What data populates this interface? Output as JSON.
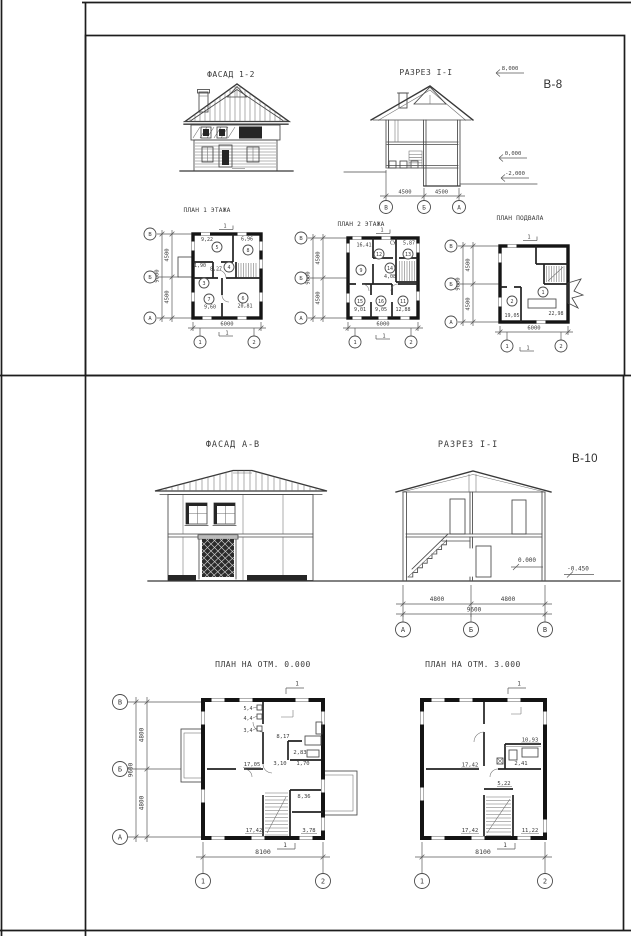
{
  "b8": {
    "code": "В-8",
    "facade_title": "ФАСАД 1-2",
    "section_title": "РАЗРЕЗ I-I",
    "elevations": [
      "8,000",
      "0,000",
      "-2,000"
    ],
    "section_dims": [
      "4500",
      "4500"
    ],
    "section_axes": [
      "В",
      "Б",
      "А"
    ],
    "plan1": {
      "title": "ПЛАН 1 ЭТАЖА",
      "grid_letters": [
        "В",
        "Б",
        "А"
      ],
      "grid_dims": [
        "4500",
        "4500"
      ],
      "grid_total": "9000",
      "bottom_dim": "6000",
      "axes": [
        "1",
        "2"
      ],
      "cut_label": "1",
      "rooms": [
        {
          "num": "5",
          "area": "9,22"
        },
        {
          "num": "8",
          "area": "6,96"
        },
        {
          "num": "4",
          "area": "8,27"
        },
        {
          "num": "3",
          "area": "1,90"
        },
        {
          "num": "7",
          "area": "9,60"
        },
        {
          "num": "6",
          "area": "20,81"
        }
      ]
    },
    "plan2": {
      "title": "ПЛАН 2 ЭТАЖА",
      "grid_letters": [
        "В",
        "Б",
        "А"
      ],
      "grid_dims": [
        "4500",
        "4500"
      ],
      "grid_total": "9000",
      "bottom_dim": "6000",
      "axes": [
        "1",
        "2"
      ],
      "cut_label": "1",
      "su_label": "СУ",
      "rooms": [
        {
          "num": "12",
          "area": "16,41"
        },
        {
          "num": "13",
          "area": "5,87"
        },
        {
          "num": "9",
          "area": ""
        },
        {
          "num": "14",
          "area": "4,08"
        },
        {
          "num": "15",
          "area": "9,01"
        },
        {
          "num": "16",
          "area": "9,05"
        },
        {
          "num": "11",
          "area": "12,88"
        }
      ]
    },
    "basement": {
      "title": "ПЛАН ПОДВАЛА",
      "grid_letters": [
        "В",
        "Б",
        "А"
      ],
      "grid_dims": [
        "4500",
        "4500"
      ],
      "grid_total": "9000",
      "bottom_dim": "6000",
      "axes": [
        "1",
        "2"
      ],
      "cut_label": "1",
      "rooms": [
        {
          "num": "2",
          "area": "19,05"
        },
        {
          "num": "1",
          "area": "22,98"
        }
      ]
    }
  },
  "b10": {
    "code": "В-10",
    "facade_title": "ФАСАД А-В",
    "section_title": "РАЗРЕЗ I-I",
    "elevation_zero": "0.000",
    "elevation_minus": "-0.450",
    "section_dims": [
      "4800",
      "4800"
    ],
    "section_total": "9600",
    "section_axes": [
      "А",
      "Б",
      "В"
    ],
    "plan0": {
      "title": "ПЛАН НА ОТМ. 0.000",
      "grid_letters": [
        "В",
        "Б",
        "А"
      ],
      "grid_dims": [
        "4800",
        "4800"
      ],
      "grid_total": "9600",
      "bottom_dim": "8100",
      "axes": [
        "1",
        "2"
      ],
      "cut_label": "1",
      "duct_labels": [
        "5,4",
        "4,4",
        "3,4"
      ],
      "areas": [
        "8,17",
        "2,83",
        "17,05",
        "3,10",
        "1,70",
        "8,36",
        "17,42",
        "3,78"
      ]
    },
    "plan3": {
      "title": "ПЛАН НА ОТМ. 3.000",
      "bottom_dim": "8100",
      "axes": [
        "1",
        "2"
      ],
      "cut_label": "1",
      "areas": [
        "10,93",
        "2,41",
        "17,42",
        "5,22",
        "17,42",
        "11,22"
      ]
    }
  }
}
